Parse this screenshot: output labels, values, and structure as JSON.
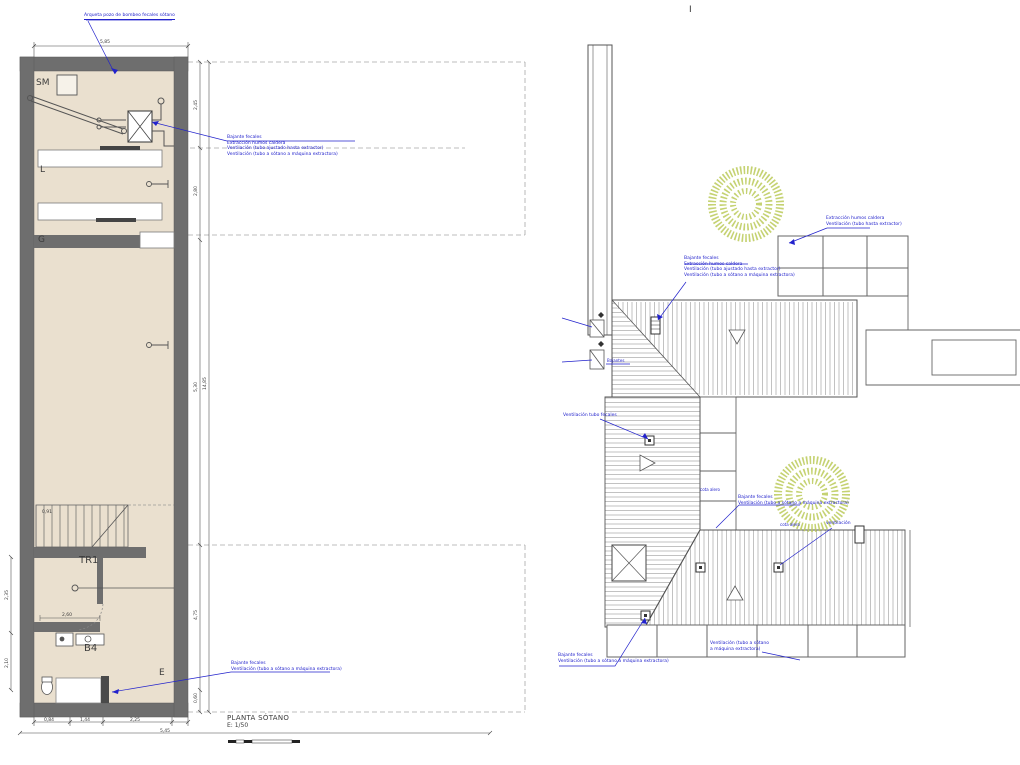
{
  "colors": {
    "wall_gray": "#6e6e6e",
    "floor_beige": "#eae0cf",
    "annotation_blue": "#2222cc",
    "stamp_green": "#bccb5a",
    "line_gray": "#555555"
  },
  "header": {
    "mark": "I"
  },
  "left_plan": {
    "title": "PLANTA SÓTANO",
    "scale_label": "E: 1/50",
    "rooms": {
      "sm": "SM",
      "l": "L",
      "g": "G",
      "tr1": "TR1",
      "b4": "B4",
      "e": "E"
    },
    "annotations": {
      "arqueta": "Arqueta pozo de bombeo fecales sótano",
      "riser_top": [
        "Bajante fecales",
        "Extracción humos caldera",
        "Ventilación (tubo ajustado hasta extractor)",
        "Ventilación (tubo a sótano a máquina extractora)"
      ],
      "riser_bottom": [
        "Bajante fecales",
        "Ventilación (tubo a sótano a máquina extractora)"
      ]
    },
    "dims": {
      "top_width": "5,85",
      "right_1": "2,45",
      "right_2": "2,80",
      "right_3": "5,30",
      "right_4": "4,75",
      "right_5": "0,60",
      "right_total": "14,85",
      "bottom_1": "0,84",
      "bottom_2": "1,44",
      "bottom_3": "2,25",
      "bottom_total": "5,45",
      "stair": "0,91",
      "tr1": "2,60",
      "left_1": "2,35",
      "left_2": "2,10"
    }
  },
  "right_plan": {
    "ann": {
      "grid": [
        "Extracción humos caldera",
        "Ventilación (tubo hasta extractor)"
      ],
      "chimney": [
        "Bajante fecales",
        "Extracción humos caldera",
        "Ventilación (tubo ajustado hasta extractor)",
        "Ventilación (tubo a sótano a máquina extractora)"
      ],
      "edge": "Bajantes",
      "vent_mid": "Ventilación tubo fecales",
      "cota_1": "cota alero",
      "cota_2": "cota alero",
      "riser_mid": [
        "Bajante fecales",
        "Ventilación (tubo a sótano a máquina extractora)"
      ],
      "vent": "ventilación",
      "riser_bottom": [
        "Bajante fecales",
        "Ventilación (tubo a sótano a máquina extractora)"
      ],
      "vent_bottom": [
        "Ventilación (tubo a sótano",
        "a máquina extractora)"
      ]
    }
  }
}
